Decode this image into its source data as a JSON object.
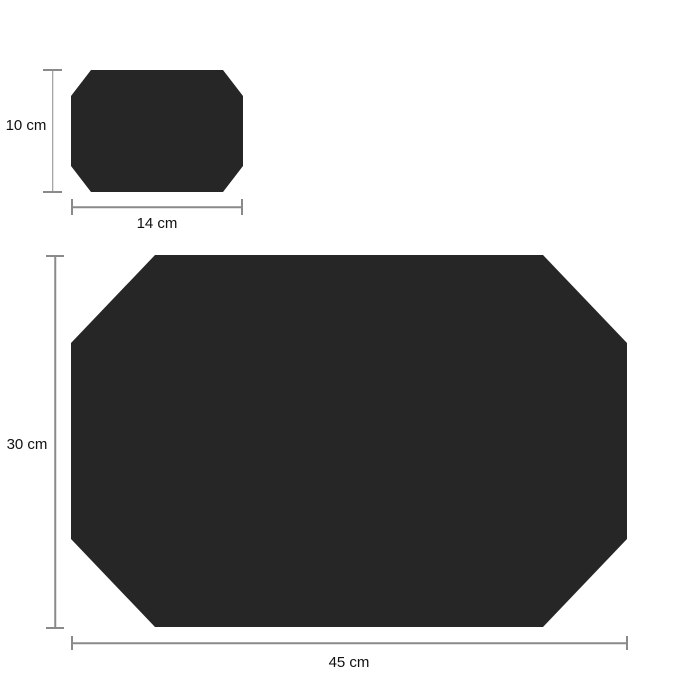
{
  "colors": {
    "background": "#ffffff",
    "shape_fill": "#262626",
    "dimension_line": "#8a8a8a",
    "label_text": "#111111"
  },
  "small_placemat": {
    "height_label": "10 cm",
    "width_label": "14 cm"
  },
  "large_placemat": {
    "height_label": "30 cm",
    "width_label": "45 cm"
  }
}
